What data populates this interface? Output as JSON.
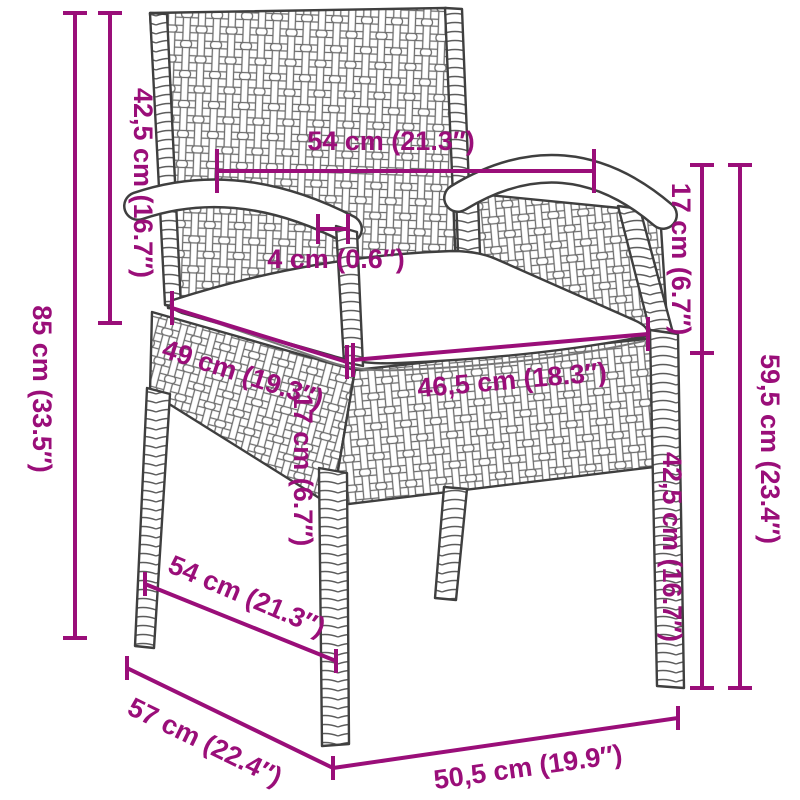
{
  "diagram": {
    "type": "product-dimension-diagram",
    "product": "poly rattan garden chair with seat cushion",
    "accent_color": "#9A0E79",
    "line_color": "#3f3f3f",
    "background_color": "#ffffff",
    "dimensions": {
      "total_height": "85 cm (33.5″)",
      "backrest_height": "42,5 cm (16.7″)",
      "top_width": "54 cm (21.3″)",
      "armrest_thickness": "4 cm (0.6″)",
      "seat_depth": "49 cm (19.3″)",
      "seat_width": "46,5 cm (18.3″)",
      "armrest_to_seat": "17 cm (6.7″)",
      "apron_height": "17 cm (6.7″)",
      "armrest_height": "59,5 cm (23.4″)",
      "seat_height": "42,5 cm (16.7″)",
      "side_depth": "54 cm (21.3″)",
      "total_depth": "57 cm (22.4″)",
      "front_width": "50,5 cm (19.9″)"
    }
  }
}
